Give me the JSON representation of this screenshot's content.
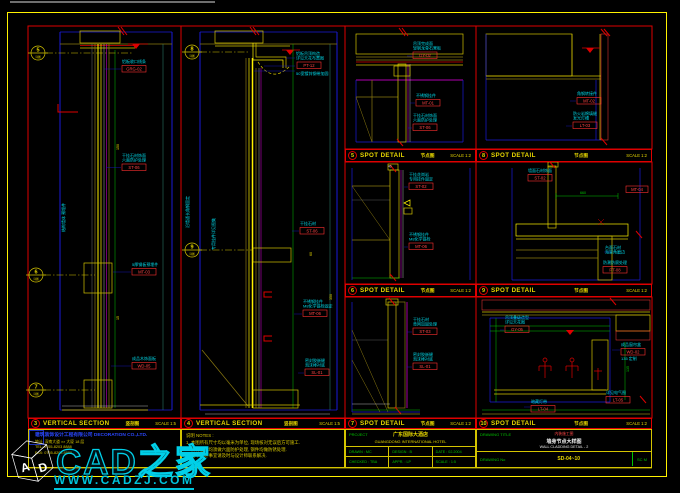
{
  "titlebars": {
    "s3": {
      "num": "3",
      "label": "VERTICAL SECTION",
      "cn": "竖剖图",
      "scale": "SCALE 1:5"
    },
    "s4": {
      "num": "4",
      "label": "VERTICAL SECTION",
      "cn": "竖剖图",
      "scale": "SCALE 1:5"
    },
    "d5": {
      "num": "5",
      "label": "SPOT DETAIL",
      "cn": "节点图",
      "scale": "SCALE 1:2"
    },
    "d8": {
      "num": "8",
      "label": "SPOT DETAIL",
      "cn": "节点图",
      "scale": "SCALE 1:2"
    },
    "d6": {
      "num": "6",
      "label": "SPOT DETAIL",
      "cn": "节点图",
      "scale": "SCALE 1:2"
    },
    "d9": {
      "num": "9",
      "label": "SPOT DETAIL",
      "cn": "节点图",
      "scale": "SCALE 1:2"
    },
    "d7": {
      "num": "7",
      "label": "SPOT DETAIL",
      "cn": "节点图",
      "scale": "SCALE 1:2"
    },
    "d10": {
      "num": "10",
      "label": "SPOT DETAIL",
      "cn": "节点图",
      "scale": "SCALE 1:2"
    }
  },
  "callouts": {
    "c5": "5",
    "c6": "6",
    "c7": "7",
    "c8": "8",
    "c9": "9",
    "sub": "详图"
  },
  "ann": {
    "s3": [
      {
        "l1": "铝板收口线条",
        "l2": "",
        "tag": "GRG-02"
      },
      {
        "l1": "干挂石材饰面",
        "l2": "六面防护处理",
        "tag": "ST-06"
      },
      {
        "l1": "5厚钢板预埋件",
        "l2": "",
        "tag": "MT-03"
      },
      {
        "l1": "成品木饰面板",
        "l2": "",
        "tag": "WD-05"
      }
    ],
    "s4": [
      {
        "l1": "铝板吊顶构造",
        "l2": "详见天花布置图",
        "tag": "PT-12",
        "extra": "50宽镀锌钢带加固"
      },
      {
        "l1": "干挂石材",
        "l2": "",
        "tag": "ST-06"
      },
      {
        "l1": "不锈钢挂件",
        "l2": "M8化学锚栓固定",
        "tag": "MT-06"
      },
      {
        "l1": "密封胶嵌缝",
        "l2": "泡沫棒衬底",
        "tag": "SL-01"
      }
    ],
    "d5": [
      {
        "l1": "吊顶完成面",
        "l2": "轻钢龙骨石膏板",
        "tag": "GY-02"
      },
      {
        "l1": "不锈钢挂件",
        "l2": "",
        "tag": "MT-01"
      },
      {
        "l1": "干挂石材饰面",
        "l2": "六面防护处理",
        "tag": "ST-06"
      }
    ],
    "d8": [
      {
        "l1": "角钢转接件",
        "l2": "",
        "tag": "MT-02"
      },
      {
        "l1": "防火岩棉填缝",
        "l2": "发光灯槽",
        "tag": "LT-03"
      }
    ],
    "d6": [
      {
        "l1": "干挂花岗岩",
        "l2": "专用挂件固定",
        "tag": "ST-02"
      },
      {
        "l1": "不锈钢挂件",
        "l2": "M8化学锚栓",
        "tag": "MT-06"
      }
    ],
    "d9": [
      {
        "l1": "墙面石材饰面",
        "tag": "ST-02"
      },
      {
        "tag": "MT-04"
      },
      {
        "l1": "台面石材",
        "l2": "海棠角磨边"
      },
      {
        "l1": "防潮防腐处理",
        "tag": "PT-08"
      }
    ],
    "d7": [
      {
        "l1": "干挂石材",
        "l2": "背网加固处理",
        "tag": "ST-03"
      },
      {
        "l1": "密封胶嵌缝",
        "l2": "泡沫棒衬底",
        "tag": "SL-01"
      }
    ],
    "d10": [
      {
        "l1": "吊顶叠级造型",
        "l2": "详见天花图",
        "tag": "GY-05"
      },
      {
        "l1": "成品窗帘盒",
        "l2": "135 定制",
        "tag": "WD-02"
      },
      {
        "l1": "暗藏灯带",
        "tag": "LT-04"
      },
      {
        "l1": "详见电气图",
        "tag": "LT-05"
      }
    ],
    "vert": {
      "s3a": "结构墙体 预埋件",
      "s4a": "沿墙通长角钢固定",
      "s4b": "专用挂件详见图集"
    }
  },
  "dims": {
    "a": "150",
    "b": "15",
    "c": "350",
    "d": "60",
    "e": "660",
    "f": "135",
    "g": "40"
  },
  "notes": {
    "lines": [
      "说明 NOTES :",
      "1. 本图所有尺寸均以毫米为单位, 现场核对无误后方可施工.",
      "2. 所有石材均须做六面防护处理, 钢件均做防锈处理.",
      "3. 图中未尽事宜请及时与设计师联系解决."
    ]
  },
  "company": {
    "name": "建筑装饰设计工程有限公司 DECORATION CO.,LTD.",
    "lines": [
      "地址: 深南大道 ×× 大厦 18 层",
      "TEL: 0755-8203 8888",
      "FAX: 0755-8203 8889"
    ]
  },
  "project": {
    "label": "PROJECT",
    "cn": "广东国际大酒店",
    "en": "GUANGDONG INTERNATIONAL HOTEL",
    "cells": [
      {
        "label": "DRAWN",
        "value": ": MC"
      },
      {
        "label": "DESIGN",
        "value": ": B"
      },
      {
        "label": "DATE",
        "value": ": 02.2004"
      },
      {
        "label": "CHECKED",
        "value": ": TBA"
      },
      {
        "label": "APPR.",
        "value": ": LP"
      },
      {
        "label": "SCALE",
        "value": ": 1:5"
      }
    ]
  },
  "titleblock": {
    "drawing_title_label": "DRAWING TITLE",
    "line_red": "内装施工图",
    "line_cn": "墙身节点大样图",
    "line_en": "WALL CLADDING DETAIL - 2",
    "drawing_no_label": "DRAWING No",
    "drawing_no": "SD-04~10",
    "right_cell": "SC M"
  },
  "watermark": {
    "brand": "CAD之家",
    "url": "WWW.CADZJ.COM",
    "cube_left": "A",
    "cube_right": "D"
  }
}
